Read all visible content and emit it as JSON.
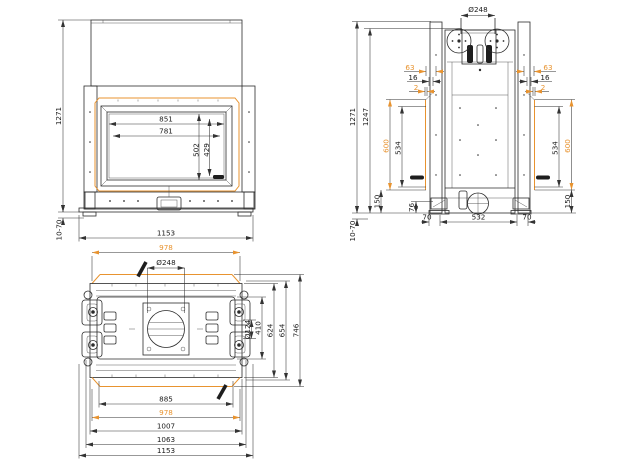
{
  "colors": {
    "accent": "#E8932F",
    "line": "#2B2B2B",
    "background": "#FFFFFF"
  },
  "front_view": {
    "overall_height": "1271",
    "opening_width": "851",
    "glass_width": "781",
    "opening_height": "502",
    "glass_height": "429",
    "overall_width": "1153",
    "foot_adjustment": "10-70"
  },
  "side_view": {
    "flue_diameter": "Ø248",
    "overall_height": "1271",
    "body_height": "1247",
    "frame_offset": "63",
    "panel_offset": "16",
    "glass_offset": "2",
    "frame_height": "600",
    "glass_height": "534",
    "plinth_height": "150",
    "foot_inset": "76",
    "foot_depth": "70",
    "base_depth": "532",
    "foot_adjustment": "10-70"
  },
  "plan_view": {
    "frame_width_top": "978",
    "flue_diameter": "Ø248",
    "pulley_diameter": "Ø124",
    "firebox_depth": "410",
    "body_depth": "624",
    "rail_depth": "654",
    "overall_depth": "746",
    "glass_width": "885",
    "frame_width_bottom": "978",
    "body_width": "1007",
    "bracket_width": "1063",
    "overall_width": "1153"
  }
}
